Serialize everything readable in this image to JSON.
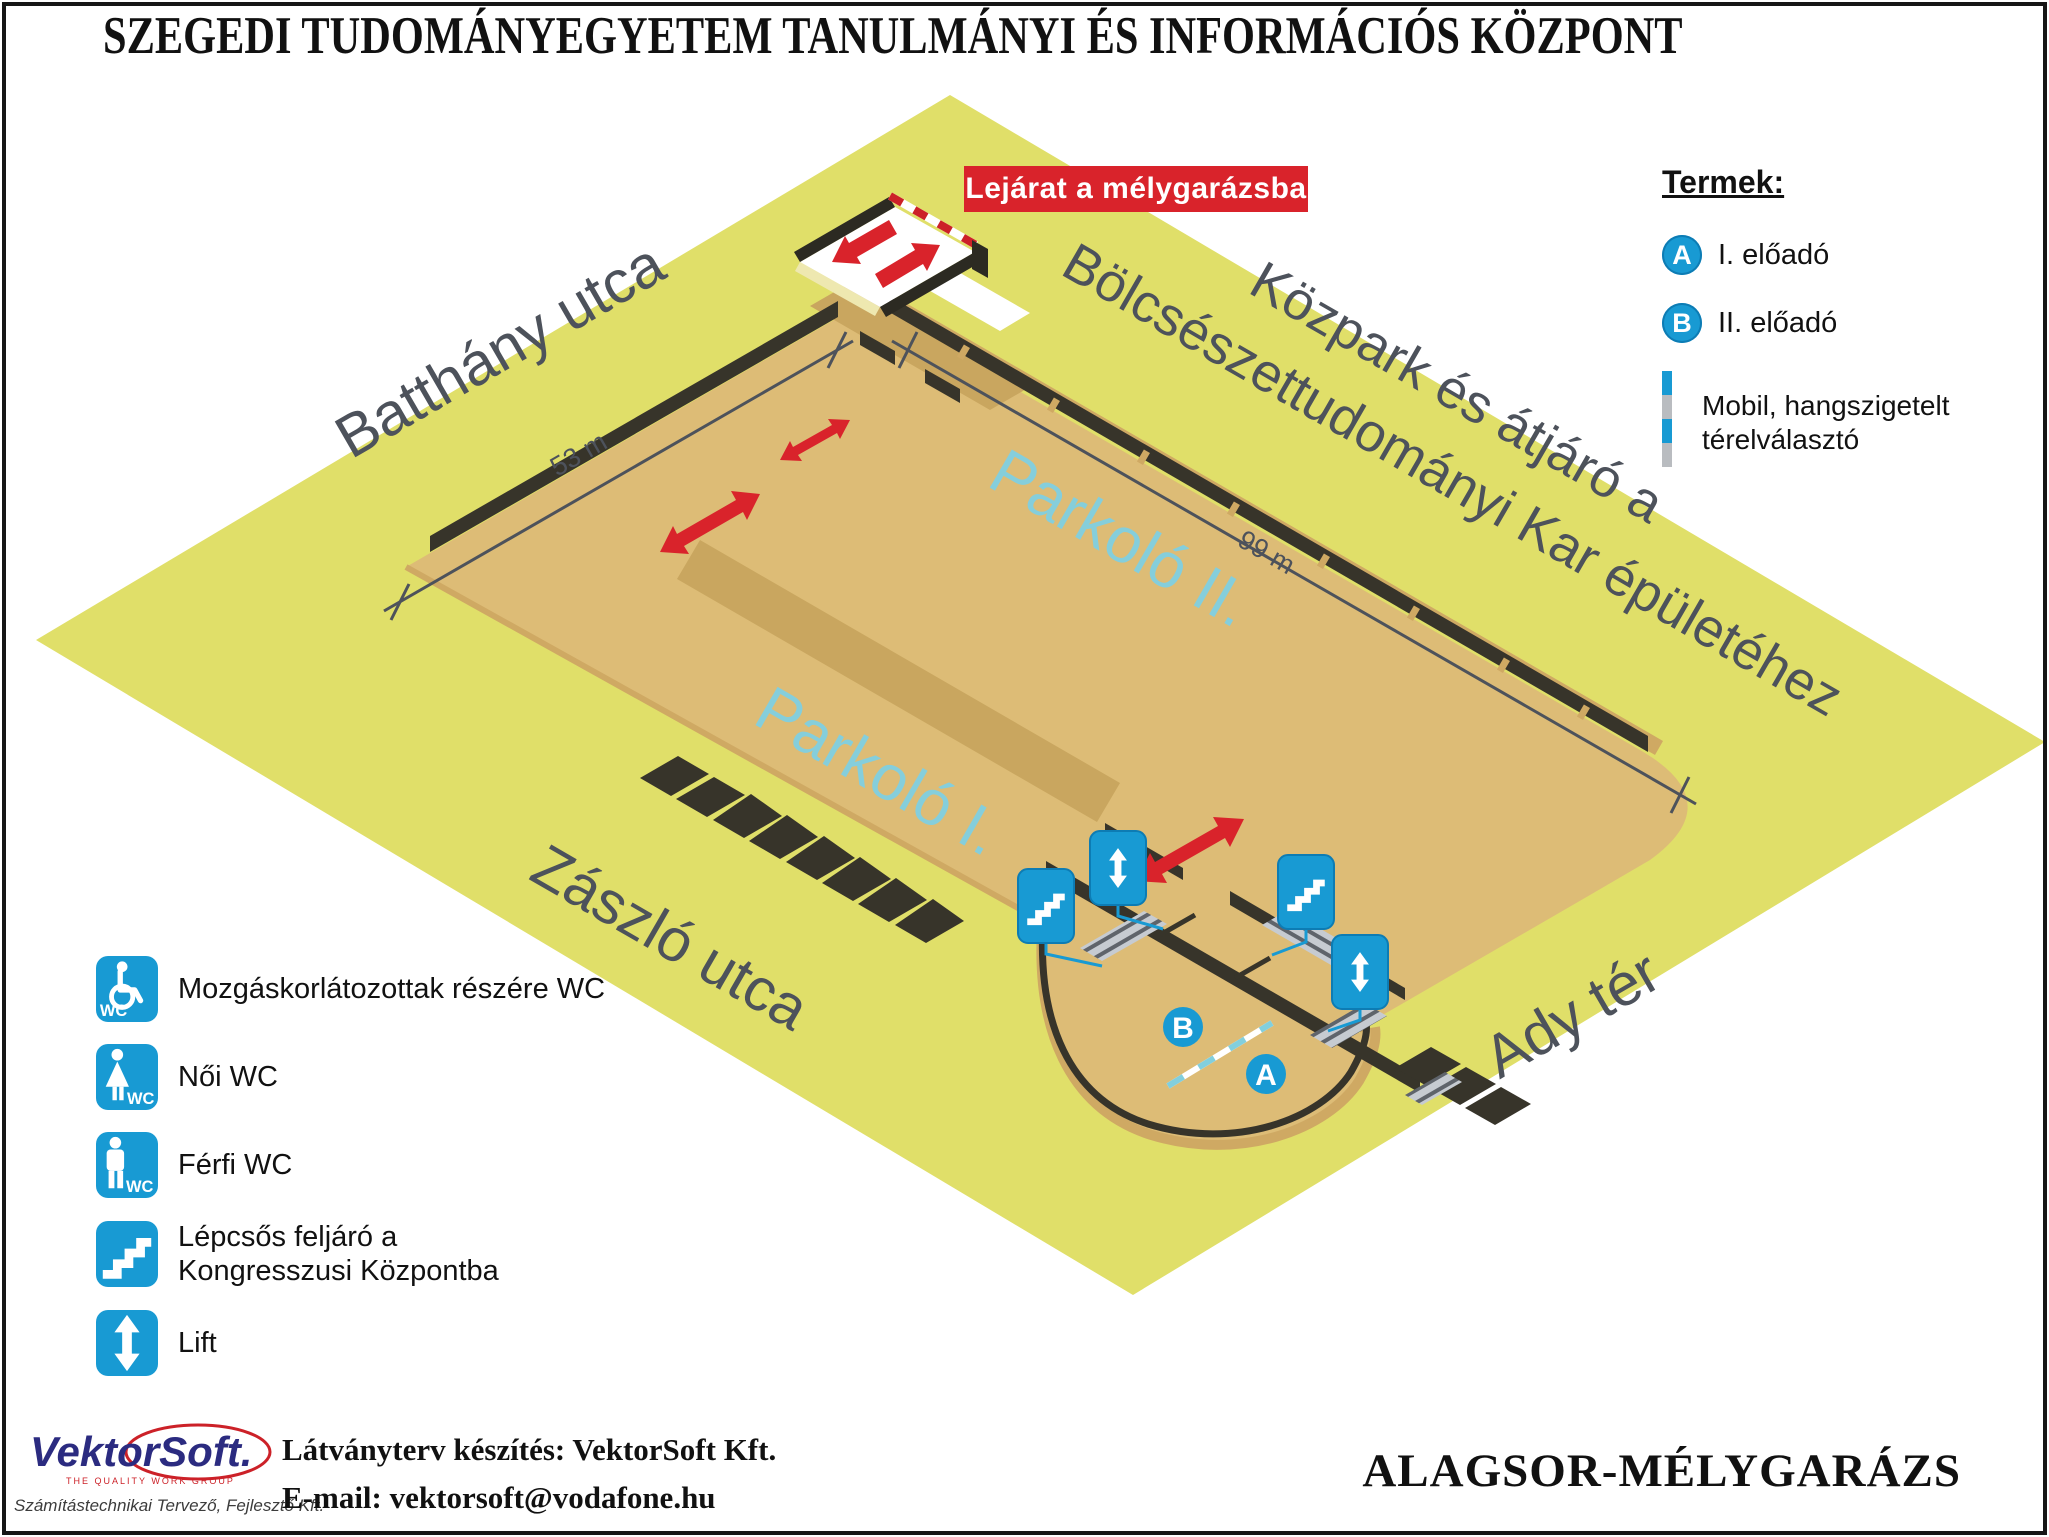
{
  "title": "SZEGEDI TUDOMÁNYEGYETEM TANULMÁNYI ÉS INFORMÁCIÓS KÖZPONT",
  "map": {
    "entrance_label": "Lejárat a mélygarázsba",
    "streets": {
      "batthany": "Batthány utca",
      "zaszlo": "Zászló utca",
      "ady": "Ady tér",
      "kozpark_line1": "Közpark és átjáró a",
      "kozpark_line2": "Bölcsészettudományi Kar épületéhez"
    },
    "areas": {
      "parkolo1": "Parkoló I.",
      "parkolo2": "Parkoló II."
    },
    "dimensions": {
      "width": "53 m",
      "length": "99 m"
    },
    "markers": {
      "a": "A",
      "b": "B"
    }
  },
  "rooms_legend": {
    "heading": "Termek:",
    "items": [
      {
        "badge": "A",
        "label": "I. előadó"
      },
      {
        "badge": "B",
        "label": "II. előadó"
      }
    ],
    "divider_label_line1": "Mobil, hangszigetelt",
    "divider_label_line2": "térelválasztó"
  },
  "facilities_legend": {
    "wc_text": "WC",
    "items": [
      {
        "icon": "wheelchair-wc",
        "label": "Mozgáskorlátozottak részére WC"
      },
      {
        "icon": "women-wc",
        "label": "Női WC"
      },
      {
        "icon": "men-wc",
        "label": "Férfi WC"
      },
      {
        "icon": "stairs",
        "label": "Lépcsős feljáró a",
        "label_line2": "Kongresszusi Központba"
      },
      {
        "icon": "lift",
        "label": "Lift"
      }
    ]
  },
  "footer": {
    "logo_text": "VektorSoft.",
    "logo_tagline": "THE QUALITY WORK GROUP",
    "logo_subtitle": "Számítástechnikai Tervező, Fejlesztő Kft.",
    "credit_line1": "Látványterv készítés: VektorSoft Kft.",
    "credit_line2": "E-mail: vektorsoft@vodafone.hu",
    "plan_title": "ALAGSOR-MÉLYGARÁZS"
  },
  "colors": {
    "accent_blue": "#189ad3",
    "signal_red": "#d9232b",
    "ground_yellow": "#e0df69",
    "floor_tan": "#ddbc76",
    "wall_dark": "#37342a",
    "street_text": "#4d525b",
    "parking_text": "#85cedb"
  }
}
